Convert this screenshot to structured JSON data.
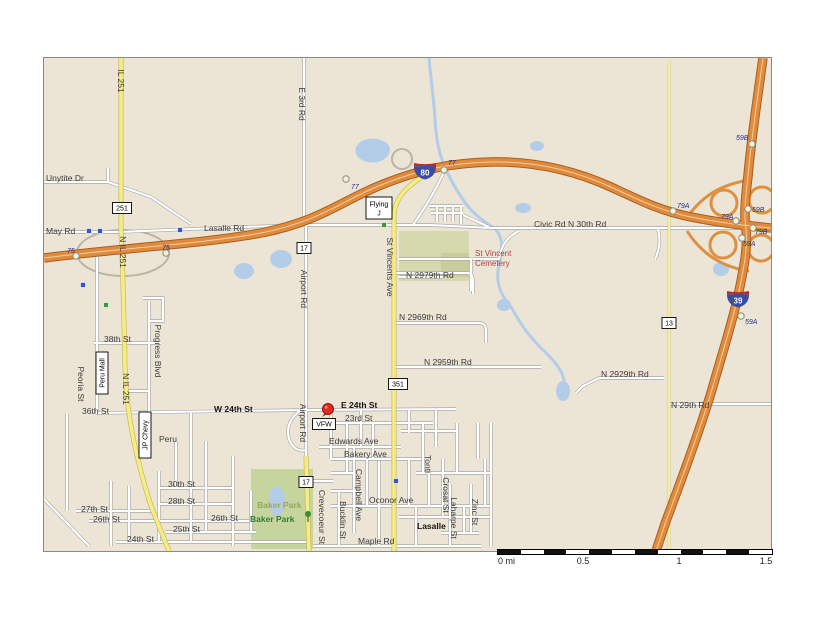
{
  "map": {
    "colors": {
      "background": "#ece5d6",
      "interstate_fill": "#e08a3c",
      "interstate_casing": "#a65f22",
      "state_route_yellow": "#f6ec85",
      "minor_road": "#ffffff",
      "water": "#b3cce8",
      "park_green": "#c6d49e",
      "cemetery_green": "#d6d9ae",
      "exit_label_blue": "#2b2b8f",
      "cemetery_text_red": "#b04040",
      "pin_red": "#e02b20"
    },
    "street_labels": [
      {
        "t": "Unytite Dr",
        "x": 45,
        "y": 180
      },
      {
        "t": "May Rd",
        "x": 45,
        "y": 233
      },
      {
        "t": "Lasalle Rd",
        "x": 203,
        "y": 230
      },
      {
        "t": "Civic Rd N 30th Rd",
        "x": 533,
        "y": 226
      },
      {
        "t": "N 2979th Rd",
        "x": 405,
        "y": 277
      },
      {
        "t": "N 2969th Rd",
        "x": 398,
        "y": 319
      },
      {
        "t": "N 2959th Rd",
        "x": 423,
        "y": 364
      },
      {
        "t": "N 2929th Rd",
        "x": 600,
        "y": 376
      },
      {
        "t": "N 29th Rd",
        "x": 670,
        "y": 407
      },
      {
        "t": "38th St",
        "x": 103,
        "y": 341
      },
      {
        "t": "36th St",
        "x": 81,
        "y": 413
      },
      {
        "t": "W 24th St",
        "x": 213,
        "y": 411,
        "c": "b"
      },
      {
        "t": "E 24th St",
        "x": 340,
        "y": 407,
        "c": "b"
      },
      {
        "t": "23rd St",
        "x": 344,
        "y": 420
      },
      {
        "t": "Edwards Ave",
        "x": 328,
        "y": 443
      },
      {
        "t": "Bakery Ave",
        "x": 343,
        "y": 456
      },
      {
        "t": "Oconor Ave",
        "x": 368,
        "y": 502
      },
      {
        "t": "Maple Rd",
        "x": 357,
        "y": 543
      },
      {
        "t": "Peru",
        "x": 158,
        "y": 441
      },
      {
        "t": "30th St",
        "x": 167,
        "y": 486
      },
      {
        "t": "28th St",
        "x": 167,
        "y": 503
      },
      {
        "t": "27th St",
        "x": 80,
        "y": 511
      },
      {
        "t": "26th St",
        "x": 92,
        "y": 521
      },
      {
        "t": "26th St",
        "x": 210,
        "y": 520
      },
      {
        "t": "25th St",
        "x": 172,
        "y": 531
      },
      {
        "t": "24th St",
        "x": 126,
        "y": 541
      },
      {
        "t": "Baker Park",
        "x": 256,
        "y": 507,
        "c": "p2"
      },
      {
        "t": "Baker Park",
        "x": 249,
        "y": 521,
        "c": "p1"
      },
      {
        "t": "Lasalle",
        "x": 416,
        "y": 528,
        "c": "b"
      },
      {
        "t": "St Vincent",
        "x": 474,
        "y": 255,
        "c": "cem"
      },
      {
        "t": "Cemetery",
        "x": 474,
        "y": 265,
        "c": "cem"
      },
      {
        "t": "IL 251",
        "x": 117,
        "y": 80,
        "r": 1
      },
      {
        "t": "N IL 251",
        "x": 119,
        "y": 251,
        "r": 1
      },
      {
        "t": "N IL 251",
        "x": 122,
        "y": 388,
        "r": 1
      },
      {
        "t": "E 3rd Rd",
        "x": 298,
        "y": 103,
        "r": 1
      },
      {
        "t": "Airport Rd",
        "x": 300,
        "y": 288,
        "r": 1
      },
      {
        "t": "Airport Rd",
        "x": 299,
        "y": 422,
        "r": 1
      },
      {
        "t": "St Vincents Ave",
        "x": 386,
        "y": 266,
        "r": 1
      },
      {
        "t": "Progress Blvd",
        "x": 154,
        "y": 350,
        "r": 1
      },
      {
        "t": "Peoria St",
        "x": 77,
        "y": 383,
        "r": 1
      },
      {
        "t": "Crevecoeur St",
        "x": 318,
        "y": 516,
        "r": 1
      },
      {
        "t": "Bucklin St",
        "x": 339,
        "y": 519,
        "r": 1
      },
      {
        "t": "Campbell Ave",
        "x": 355,
        "y": 494,
        "r": 1
      },
      {
        "t": "Tonti",
        "x": 424,
        "y": 463,
        "r": 1
      },
      {
        "t": "Crosat St",
        "x": 442,
        "y": 494,
        "r": 1
      },
      {
        "t": "Laharpe St",
        "x": 450,
        "y": 517,
        "r": 1
      },
      {
        "t": "Zinc St",
        "x": 471,
        "y": 511,
        "r": 1
      }
    ],
    "exit_labels": [
      {
        "t": "75",
        "x": 66,
        "y": 252
      },
      {
        "t": "75",
        "x": 161,
        "y": 249
      },
      {
        "t": "77",
        "x": 350,
        "y": 188
      },
      {
        "t": "77",
        "x": 447,
        "y": 164
      },
      {
        "t": "79A",
        "x": 676,
        "y": 207
      },
      {
        "t": "59B",
        "x": 735,
        "y": 139
      },
      {
        "t": "59B",
        "x": 751,
        "y": 211
      },
      {
        "t": "79A",
        "x": 720,
        "y": 218
      },
      {
        "t": "79B",
        "x": 754,
        "y": 233
      },
      {
        "t": "59A",
        "x": 742,
        "y": 245
      },
      {
        "t": "59A",
        "x": 744,
        "y": 323
      }
    ],
    "exit_dots": [
      [
        75,
        255
      ],
      [
        165,
        252
      ],
      [
        345,
        178
      ],
      [
        443,
        169
      ],
      [
        672,
        210
      ],
      [
        751,
        143
      ],
      [
        747,
        208
      ],
      [
        735,
        220
      ],
      [
        752,
        227
      ],
      [
        741,
        237
      ],
      [
        740,
        315
      ]
    ],
    "route_boxes": [
      {
        "t": "251",
        "x": 121,
        "y": 207,
        "w": 19,
        "h": 11
      },
      {
        "t": "17",
        "x": 303,
        "y": 247,
        "w": 14,
        "h": 11
      },
      {
        "t": "17",
        "x": 305,
        "y": 481,
        "w": 14,
        "h": 11
      },
      {
        "t": "351",
        "x": 397,
        "y": 383,
        "w": 19,
        "h": 11
      },
      {
        "t": "13",
        "x": 668,
        "y": 322,
        "w": 14,
        "h": 11
      },
      {
        "t": "VFW",
        "x": 323,
        "y": 423,
        "w": 23,
        "h": 11
      },
      {
        "t": "Flying|J",
        "x": 378,
        "y": 207,
        "w": 26,
        "h": 22
      },
      {
        "t": "Peru Mall",
        "x": 101,
        "y": 372,
        "w": 42,
        "h": 12,
        "v": 1
      },
      {
        "t": "JP Chevy",
        "x": 144,
        "y": 434,
        "w": 46,
        "h": 12,
        "v": 1
      }
    ],
    "shields": [
      {
        "n": "80",
        "x": 424,
        "y": 170
      },
      {
        "n": "39",
        "x": 737,
        "y": 298
      }
    ],
    "icons": {
      "blue_squares": [
        [
          88,
          230
        ],
        [
          99,
          230
        ],
        [
          179,
          229
        ],
        [
          82,
          284
        ],
        [
          395,
          480
        ]
      ],
      "green_squares": [
        [
          105,
          304
        ],
        [
          383,
          224
        ]
      ],
      "trees": [
        [
          307,
          516
        ]
      ]
    },
    "pin": {
      "x": 327,
      "y": 408
    }
  },
  "scale_bar": {
    "x": 497,
    "y": 550,
    "width": 274,
    "height": 5,
    "segments": 12,
    "labels": [
      {
        "t": "0 mi",
        "dx": 1,
        "a": "start"
      },
      {
        "t": "0.5",
        "dx": 86
      },
      {
        "t": "1",
        "dx": 182
      },
      {
        "t": "1.5",
        "dx": 269
      }
    ]
  }
}
